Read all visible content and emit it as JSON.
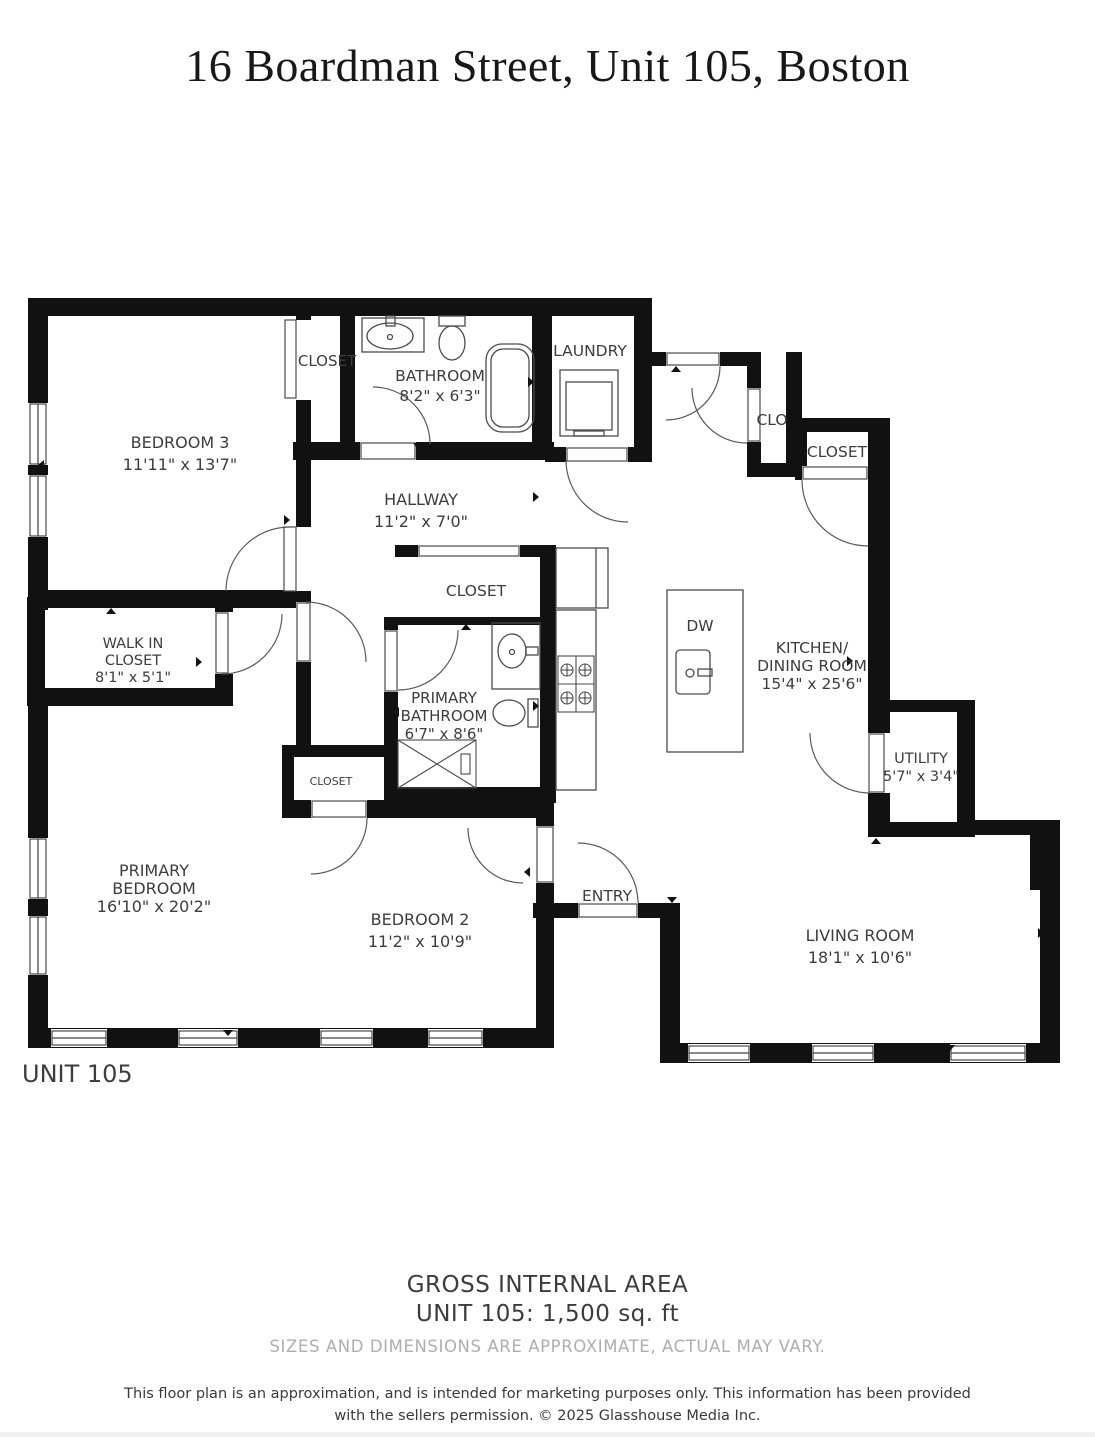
{
  "title": "16 Boardman Street, Unit 105, Boston",
  "unit_label": "UNIT 105",
  "colors": {
    "wall": "#111111",
    "label": "#3d3d3d",
    "muted": "#aeaeae"
  },
  "rooms": {
    "bedroom3": {
      "name": "BEDROOM 3",
      "dims": "11'11\" x 13'7\""
    },
    "closet_top": {
      "name": "CLOSET"
    },
    "bathroom": {
      "name": "BATHROOM",
      "dims": "8'2\" x 6'3\""
    },
    "laundry": {
      "name": "LAUNDRY"
    },
    "clo": {
      "name": "CLO"
    },
    "closet_right": {
      "name": "CLOSET"
    },
    "hallway": {
      "name": "HALLWAY",
      "dims": "11'2\" x 7'0\""
    },
    "closet_mid": {
      "name": "CLOSET"
    },
    "walk_in_closet": {
      "line1": "WALK IN",
      "line2": "CLOSET",
      "dims": "8'1\" x 5'1\""
    },
    "island": {
      "name": "DW"
    },
    "kitchen": {
      "line1": "KITCHEN/",
      "line2": "DINING ROOM",
      "dims": "15'4\" x 25'6\""
    },
    "primary_bathroom": {
      "line1": "PRIMARY",
      "line2": "BATHROOM",
      "dims": "6'7\" x 8'6\""
    },
    "utility": {
      "name": "UTILITY",
      "dims": "5'7\" x 3'4\""
    },
    "closet_small": {
      "name": "CLOSET"
    },
    "primary_bedroom": {
      "line1": "PRIMARY",
      "line2": "BEDROOM",
      "dims": "16'10\" x 20'2\""
    },
    "bedroom2": {
      "name": "BEDROOM 2",
      "dims": "11'2\" x 10'9\""
    },
    "entry": {
      "name": "ENTRY"
    },
    "living_room": {
      "name": "LIVING ROOM",
      "dims": "18'1\" x 10'6\""
    }
  },
  "footer": {
    "gross_area_title": "GROSS INTERNAL AREA",
    "gross_area_value": "UNIT 105: 1,500 sq. ft",
    "sizes_note": "SIZES AND DIMENSIONS ARE APPROXIMATE, ACTUAL MAY VARY.",
    "disclaimer": "This floor plan is an approximation, and is intended for marketing purposes only. This information has been provided with the sellers permission. © 2025 Glasshouse Media Inc."
  }
}
